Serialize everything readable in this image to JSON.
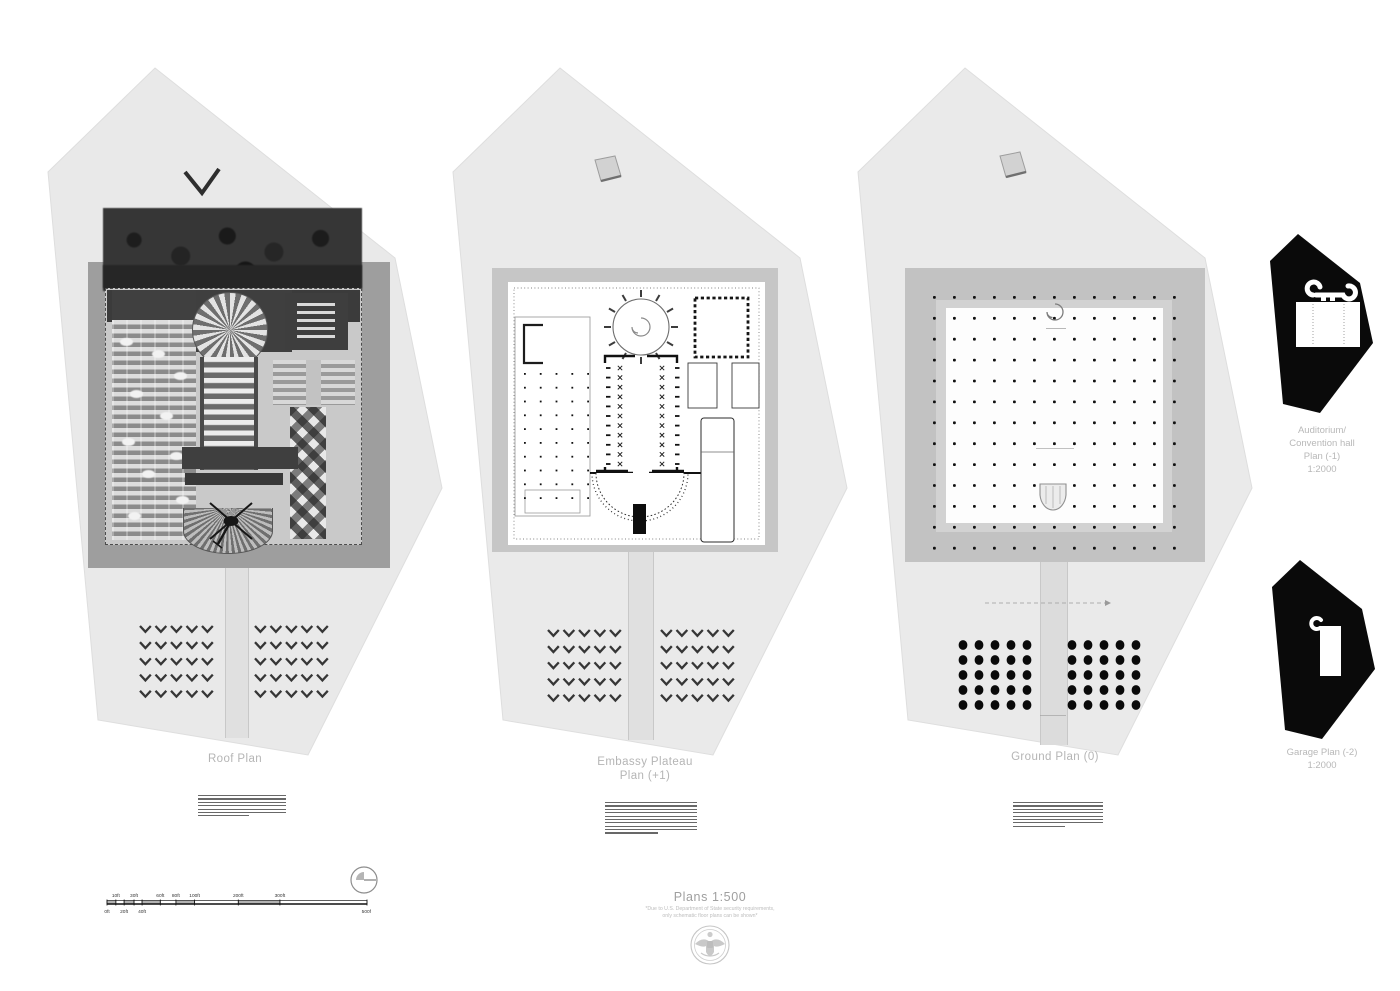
{
  "sheet": {
    "background": "#ffffff",
    "drawing_type": "architectural site / floor plans presentation sheet"
  },
  "plans": [
    {
      "id": "roof",
      "title": "Roof Plan"
    },
    {
      "id": "plateau",
      "title_line1": "Embassy Plateau",
      "title_line2": "Plan (+1)"
    },
    {
      "id": "ground",
      "title": "Ground Plan (0)"
    }
  ],
  "side_plans": [
    {
      "id": "auditorium",
      "label_lines": [
        "Auditorium/",
        "Convention hall",
        "Plan (-1)",
        "1:2000"
      ]
    },
    {
      "id": "garage",
      "label_lines": [
        "Garage Plan (-2)",
        "1:2000"
      ]
    }
  ],
  "footer": {
    "title": "Plans 1:500",
    "note_line1": "*Due to U.S. Department of State security requirements,",
    "note_line2": "only schematic floor plans can be shown*",
    "seal": "great-seal-of-the-united-states"
  },
  "scale_bar": {
    "unit": "ft",
    "ticks": [
      {
        "label": "0ft",
        "pos": 0.0,
        "side": "bottom"
      },
      {
        "label": "10ft",
        "pos": 0.034,
        "side": "top"
      },
      {
        "label": "20ft",
        "pos": 0.066,
        "side": "bottom"
      },
      {
        "label": "30ft",
        "pos": 0.104,
        "side": "top"
      },
      {
        "label": "40ft",
        "pos": 0.135,
        "side": "bottom"
      },
      {
        "label": "60ft",
        "pos": 0.205,
        "side": "top"
      },
      {
        "label": "80ft",
        "pos": 0.265,
        "side": "top"
      },
      {
        "label": "100ft",
        "pos": 0.337,
        "side": "top"
      },
      {
        "label": "200ft",
        "pos": 0.505,
        "side": "top"
      },
      {
        "label": "300ft",
        "pos": 0.665,
        "side": "top"
      },
      {
        "label": "500ft",
        "pos": 1.0,
        "side": "bottom"
      }
    ]
  },
  "colors": {
    "parcel_fill": "#e9e9e9",
    "plateau_gray": "#c6c6c6",
    "roof_plateau_gray": "#9e9e9e",
    "silhouette_black": "#0a0a0a",
    "label_gray": "#b5b5b5",
    "linework_black": "#141414"
  }
}
